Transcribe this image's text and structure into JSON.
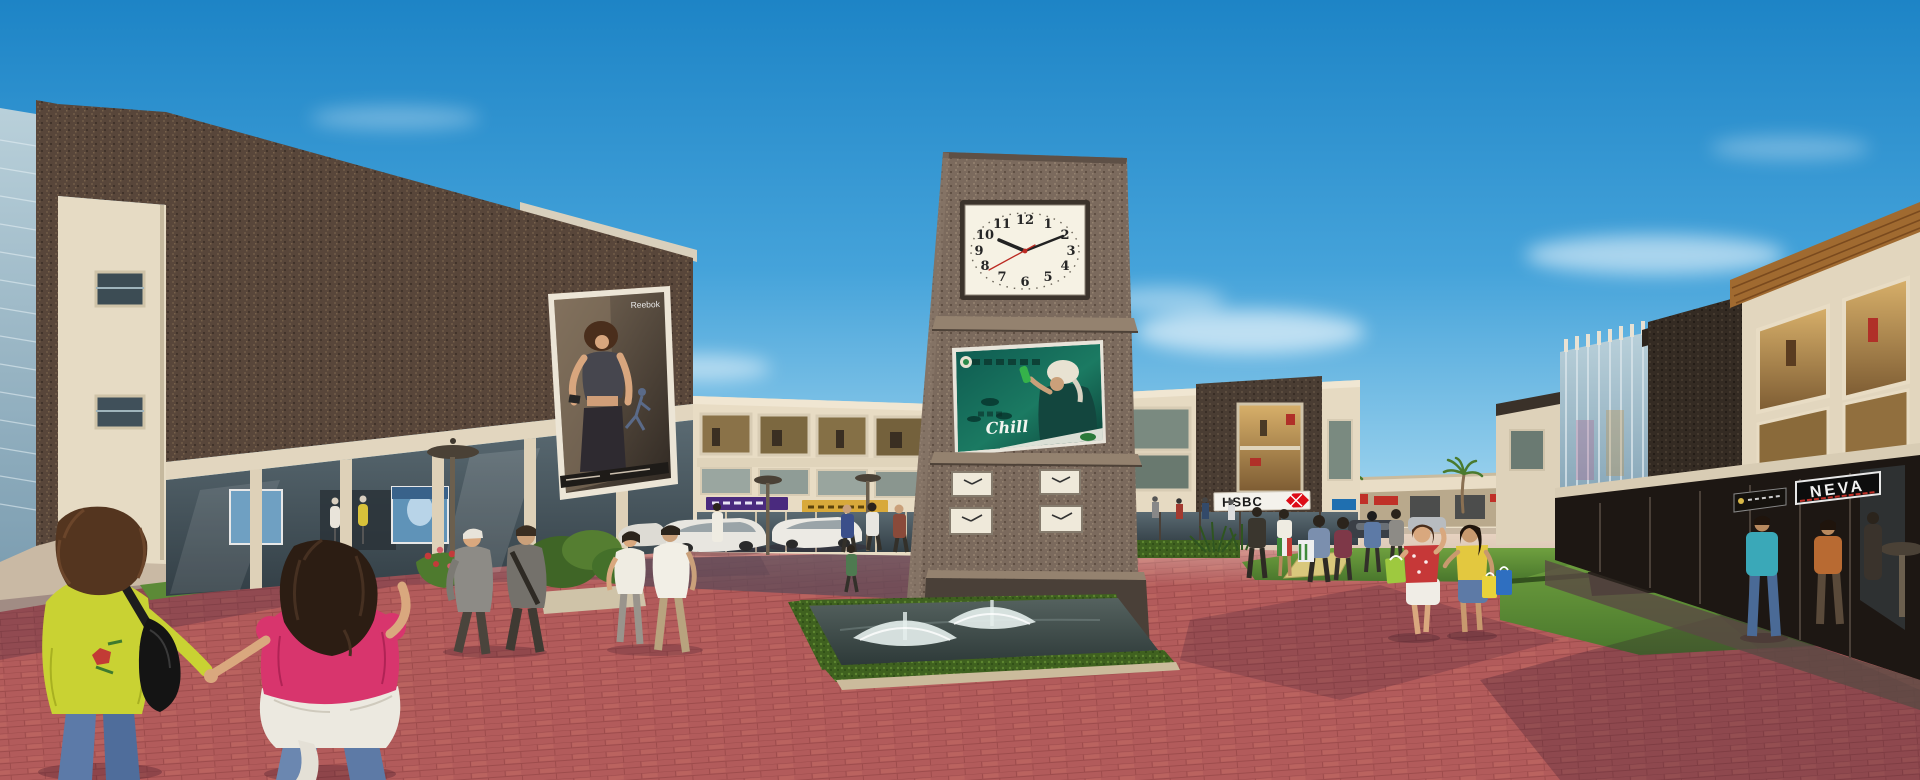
{
  "scene": {
    "description": "Architectural rendering of an outdoor retail plaza: brick clock tower with billboard and fountain, shop buildings, parked cars and pedestrians under a blue sky",
    "palette": {
      "sky": "#2e96d2",
      "tower_brick": "#7b6a5d",
      "dark_brick": "#58463a",
      "paving": "#b25b5b",
      "lawn": "#5f8f3a",
      "stone_trim": "#e6dbc4"
    }
  },
  "clock_tower": {
    "main_clock": {
      "numerals": [
        "12",
        "1",
        "2",
        "3",
        "4",
        "5",
        "6",
        "7",
        "8",
        "9",
        "10",
        "11"
      ],
      "time": "10:09",
      "face_color": "#f6f2e4",
      "second_hand_color": "#bb2a22"
    },
    "small_clocks": {
      "count": 4,
      "layout": "2 x 2 grid"
    },
    "billboard": {
      "brand_text": "Chill",
      "panel_color": "#10584c"
    }
  },
  "signs": {
    "hsbc_label": "HSBC",
    "hsbc_logo_color": "#dd0c17",
    "neva_label": "NEVA"
  },
  "poster": {
    "brand_text": "Reebok"
  }
}
